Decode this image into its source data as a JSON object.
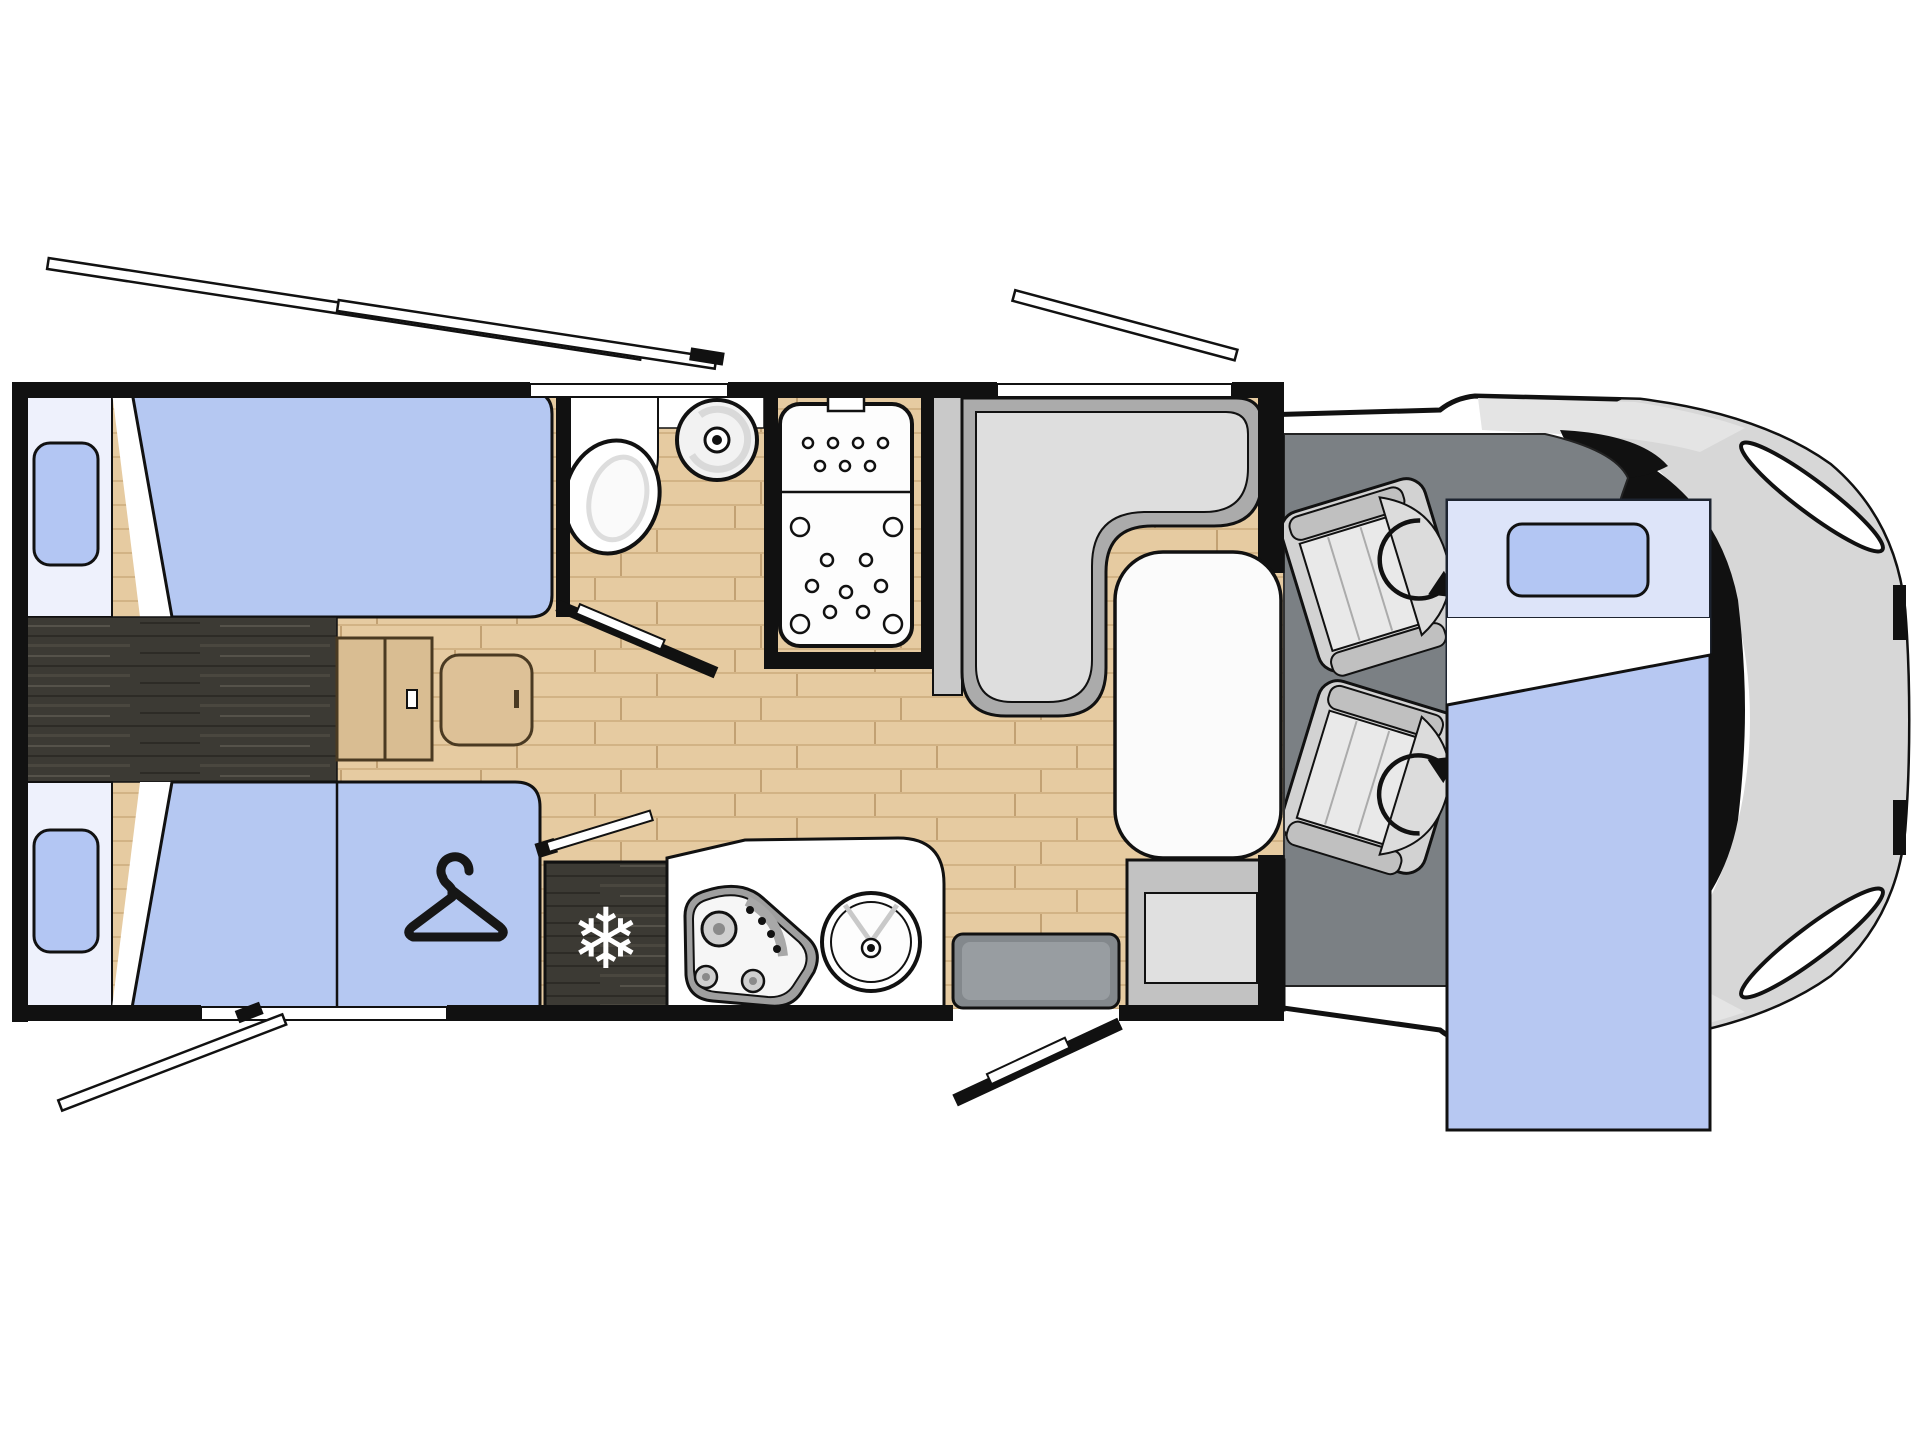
{
  "diagram": {
    "kind": "motorhome-floorplan-top-view",
    "icons": {
      "snowflake": "❄",
      "hanger": "hanger-icon",
      "swivel_arrow": "rotation-arrow-icon"
    },
    "colors": {
      "wall": "#111111",
      "floor_wood": "#e6cba1",
      "floor_wood_line": "#d2b385",
      "walkway_dark": "#3c3a34",
      "bed_blue": "#b5c8f2",
      "pillow_blue": "#b3c6f3",
      "headboard": "#eef1fc",
      "bed_head_zone_right": "#dde4f9",
      "wardrobe_blue": "#b5c8f2",
      "sofa_border": "#ababab",
      "sofa_seat": "#dedede",
      "table_white": "#fbfbfb",
      "cab_floor": "#7b8084",
      "seat_gray": "#d2d2d2",
      "seat_armrest": "#c0c0c0",
      "fridge_dark": "#3c3a34",
      "counter_white": "#ffffff",
      "cabinet_wood": "#d9bd92",
      "entry_step": "#83888c",
      "entrance_cabinet": "#c2c2c2",
      "cab_body": "#ffffff",
      "cab_nose_gray": "#d7d7d7",
      "windscreen": "#111111"
    }
  }
}
